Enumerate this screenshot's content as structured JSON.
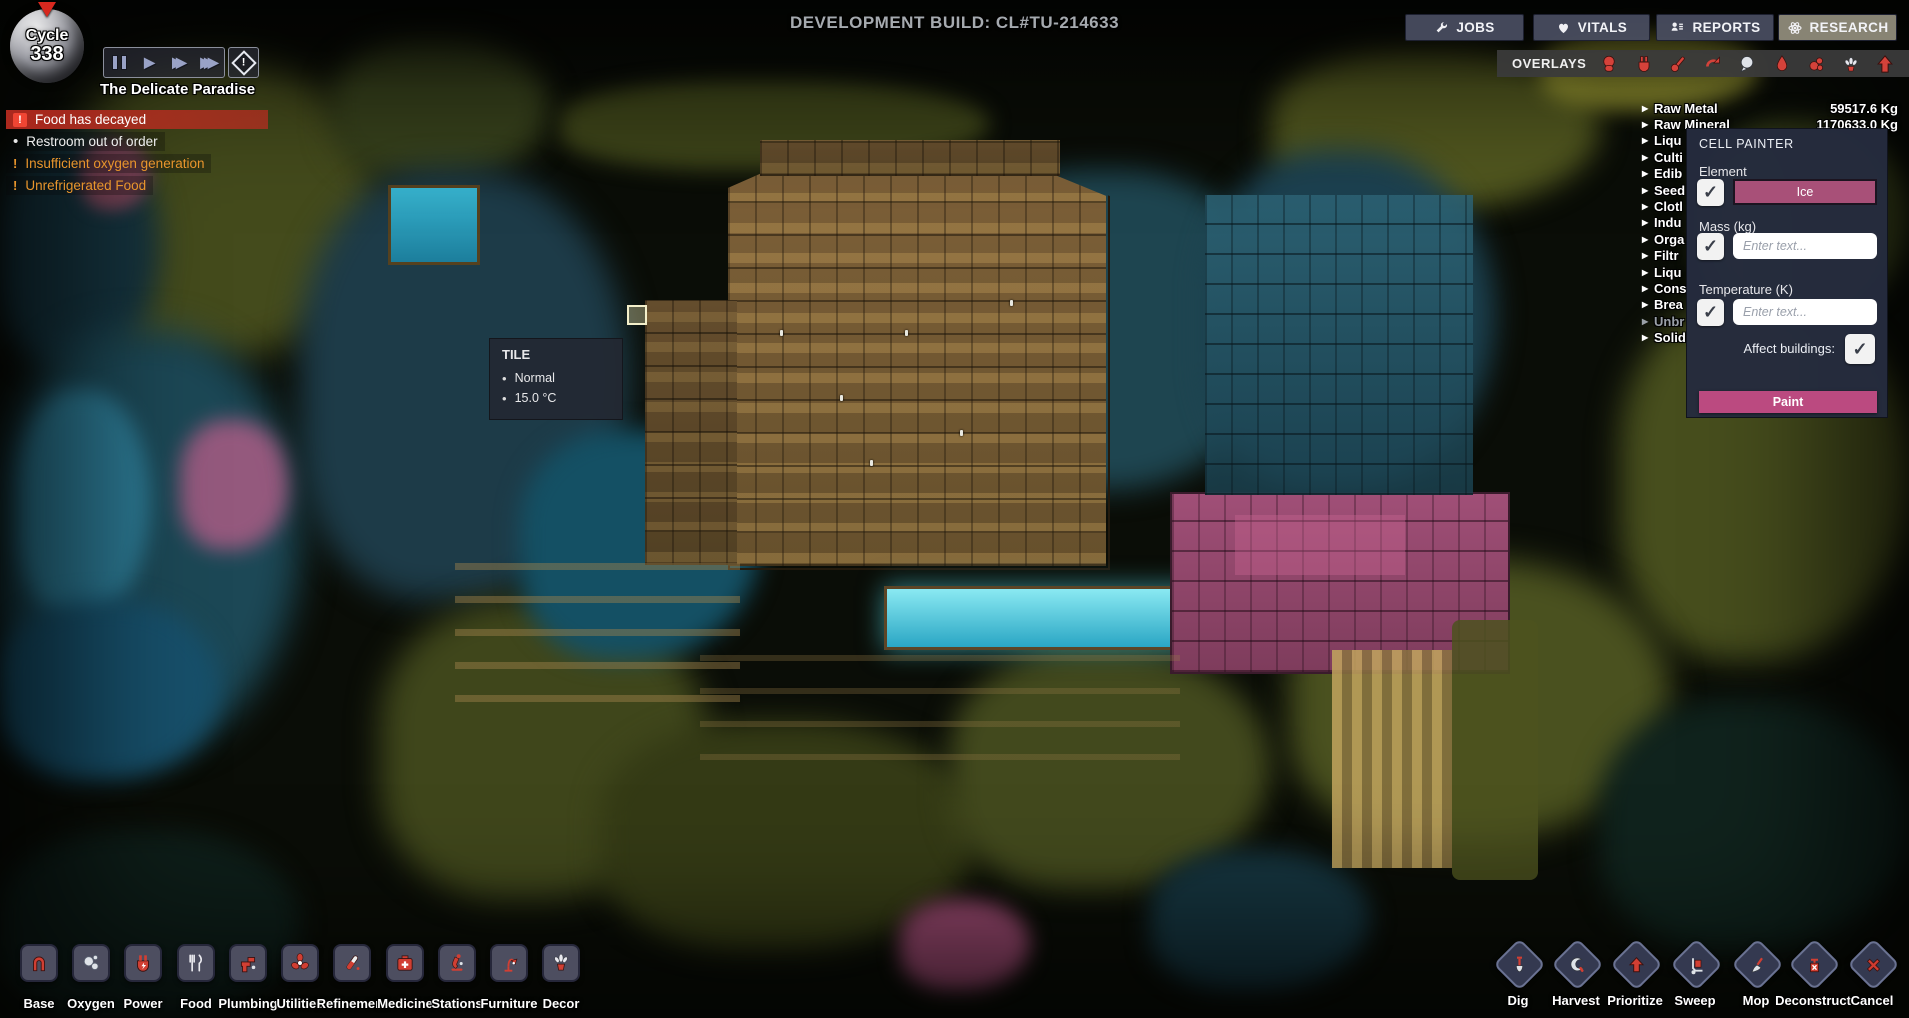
{
  "glyphs": {
    "check": "✓",
    "arrow": "▶",
    "bullet": "•",
    "exclaim": "!",
    "play": "▶",
    "fast": "▶▶",
    "fastest": "▶▶▶"
  },
  "hud": {
    "cycle_label": "Cycle",
    "cycle_number": "338",
    "duplicants": "8",
    "stress": "7%",
    "calories": "105,000 kcal",
    "colony_name": "The Delicate Paradise",
    "dev_build": "DEVELOPMENT BUILD: CL#TU-214633",
    "alerts": [
      {
        "text": "Food has decayed",
        "severity": "critical"
      },
      {
        "text": "Restroom out of order",
        "severity": "notice"
      },
      {
        "text": "Insufficient oxygen generation",
        "severity": "warning"
      },
      {
        "text": "Unrefrigerated Food",
        "severity": "warning"
      }
    ]
  },
  "top_menu": {
    "buttons": [
      {
        "label": "JOBS",
        "icon": "wrench-icon"
      },
      {
        "label": "VITALS",
        "icon": "heart-icon"
      },
      {
        "label": "REPORTS",
        "icon": "report-person-icon"
      },
      {
        "label": "RESEARCH",
        "icon": "atom-icon",
        "selected": true
      }
    ]
  },
  "overlays": {
    "label": "OVERLAYS",
    "icons": [
      "oxygen-overlay-icon",
      "power-overlay-icon",
      "temperature-overlay-icon",
      "conveyor-overlay-icon",
      "germ-overlay-icon",
      "liquid-overlay-icon",
      "farming-overlay-icon",
      "decor-overlay-icon",
      "priority-overlay-icon"
    ]
  },
  "resources": {
    "rows": [
      {
        "label": "Raw Metal",
        "value": "59517.6 Kg"
      },
      {
        "label": "Raw Mineral",
        "value": "1170633.0 Kg"
      },
      {
        "label": "Liqu"
      },
      {
        "label": "Culti"
      },
      {
        "label": "Edib"
      },
      {
        "label": "Seed"
      },
      {
        "label": "Clotl"
      },
      {
        "label": "Indu"
      },
      {
        "label": "Orga"
      },
      {
        "label": "Filtr"
      },
      {
        "label": "Liqu"
      },
      {
        "label": "Cons"
      },
      {
        "label": "Brea"
      },
      {
        "label": "Unbr",
        "muted": true
      },
      {
        "label": "Solid"
      }
    ]
  },
  "cell_painter": {
    "title": "CELL PAINTER",
    "element_label": "Element",
    "element_value": "Ice",
    "mass_label": "Mass (kg)",
    "mass_placeholder": "Enter text...",
    "temperature_label": "Temperature (K)",
    "temperature_placeholder": "Enter text...",
    "affect_buildings_label": "Affect buildings:",
    "paint_label": "Paint",
    "accent_color": "#bb4a80"
  },
  "tooltip": {
    "title": "TILE",
    "item1": "Normal",
    "item2": "15.0 °C"
  },
  "build_menu": [
    {
      "label": "Base",
      "icon": "base-icon"
    },
    {
      "label": "Oxygen",
      "icon": "oxygen-icon"
    },
    {
      "label": "Power",
      "icon": "power-icon"
    },
    {
      "label": "Food",
      "icon": "food-icon"
    },
    {
      "label": "Plumbing",
      "icon": "plumbing-icon"
    },
    {
      "label": "Utilities",
      "icon": "utilities-icon"
    },
    {
      "label": "Refinement",
      "icon": "refinement-icon"
    },
    {
      "label": "Medicine",
      "icon": "medicine-icon"
    },
    {
      "label": "Stations",
      "icon": "stations-icon"
    },
    {
      "label": "Furniture",
      "icon": "furniture-icon"
    },
    {
      "label": "Decor",
      "icon": "decor-icon"
    }
  ],
  "tools_menu": [
    {
      "label": "Dig",
      "icon": "dig-icon"
    },
    {
      "label": "Harvest",
      "icon": "harvest-icon"
    },
    {
      "label": "Prioritize",
      "icon": "prioritize-icon"
    },
    {
      "label": "Sweep",
      "icon": "sweep-icon"
    },
    {
      "label": "Mop",
      "icon": "mop-icon"
    },
    {
      "label": "Deconstruct",
      "icon": "deconstruct-icon"
    },
    {
      "label": "Cancel",
      "icon": "cancel-icon"
    }
  ]
}
